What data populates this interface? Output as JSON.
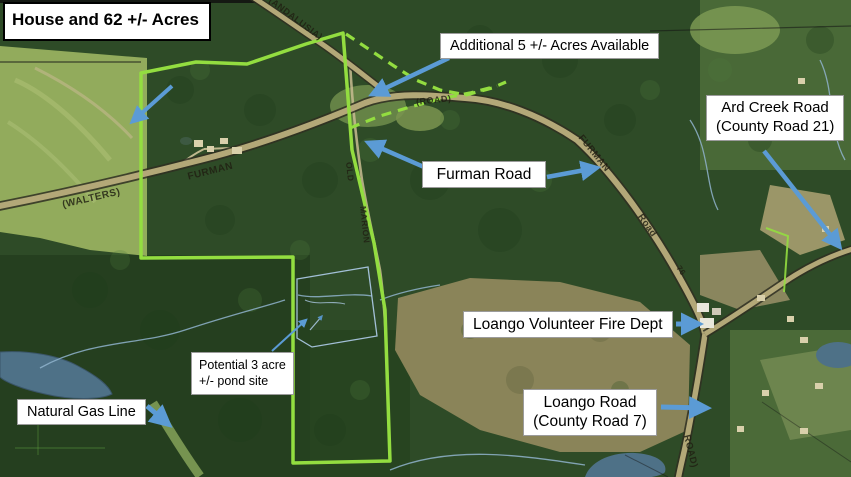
{
  "title_box": {
    "line1": "House and",
    "line2": "62 +/- Acres"
  },
  "callouts": {
    "additional_acres": {
      "text": "Additional 5 +/- Acres Available"
    },
    "furman_road": {
      "text": "Furman Road"
    },
    "ard_creek_road": {
      "line1": "Ard Creek Road",
      "line2": "(County Road 21)"
    },
    "fire_dept": {
      "text": "Loango Volunteer Fire Dept"
    },
    "loango_road": {
      "line1": "Loango Road",
      "line2": "(County Road 7)"
    },
    "pond_site": {
      "line1": "Potential 3 acre",
      "line2": "+/- pond site"
    },
    "gas_line": {
      "text": "Natural Gas Line"
    }
  },
  "map_road_labels": {
    "walters": "(WALTERS)",
    "furman_west": "FURMAN",
    "road_center": "(ROAD)",
    "top_road": "(ANDALUSIA)",
    "furman_east": "FURMAN",
    "road_east": "Road",
    "road_south": "ROAD)",
    "old_road_1": "OLD",
    "old_road_2": "MARION",
    "lot_number": "76"
  },
  "colors": {
    "boundary_green": "#93DD40",
    "arrow_blue": "#5B9BD5",
    "water_blue": "#4E7187",
    "pond_outline_blue": "#A9C6E0"
  }
}
